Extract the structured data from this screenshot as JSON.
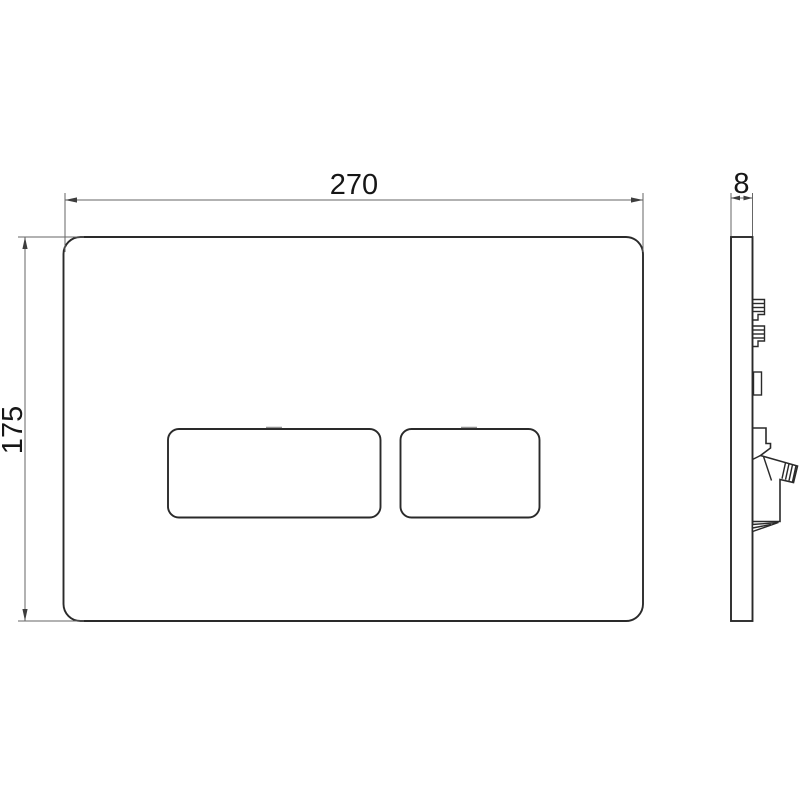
{
  "drawing": {
    "subject": "dual-flush-wall-plate-technical-drawing",
    "views": {
      "front": "front-view-with-two-flush-buttons",
      "side": "side-profile-with-mounting-clips"
    },
    "dimensions": {
      "width": "270",
      "height": "175",
      "depth": "8"
    },
    "colors": {
      "background": "#ffffff",
      "outline": "#2a2a2a",
      "dimension_lines": "#666666",
      "label_text": "#161616"
    }
  }
}
